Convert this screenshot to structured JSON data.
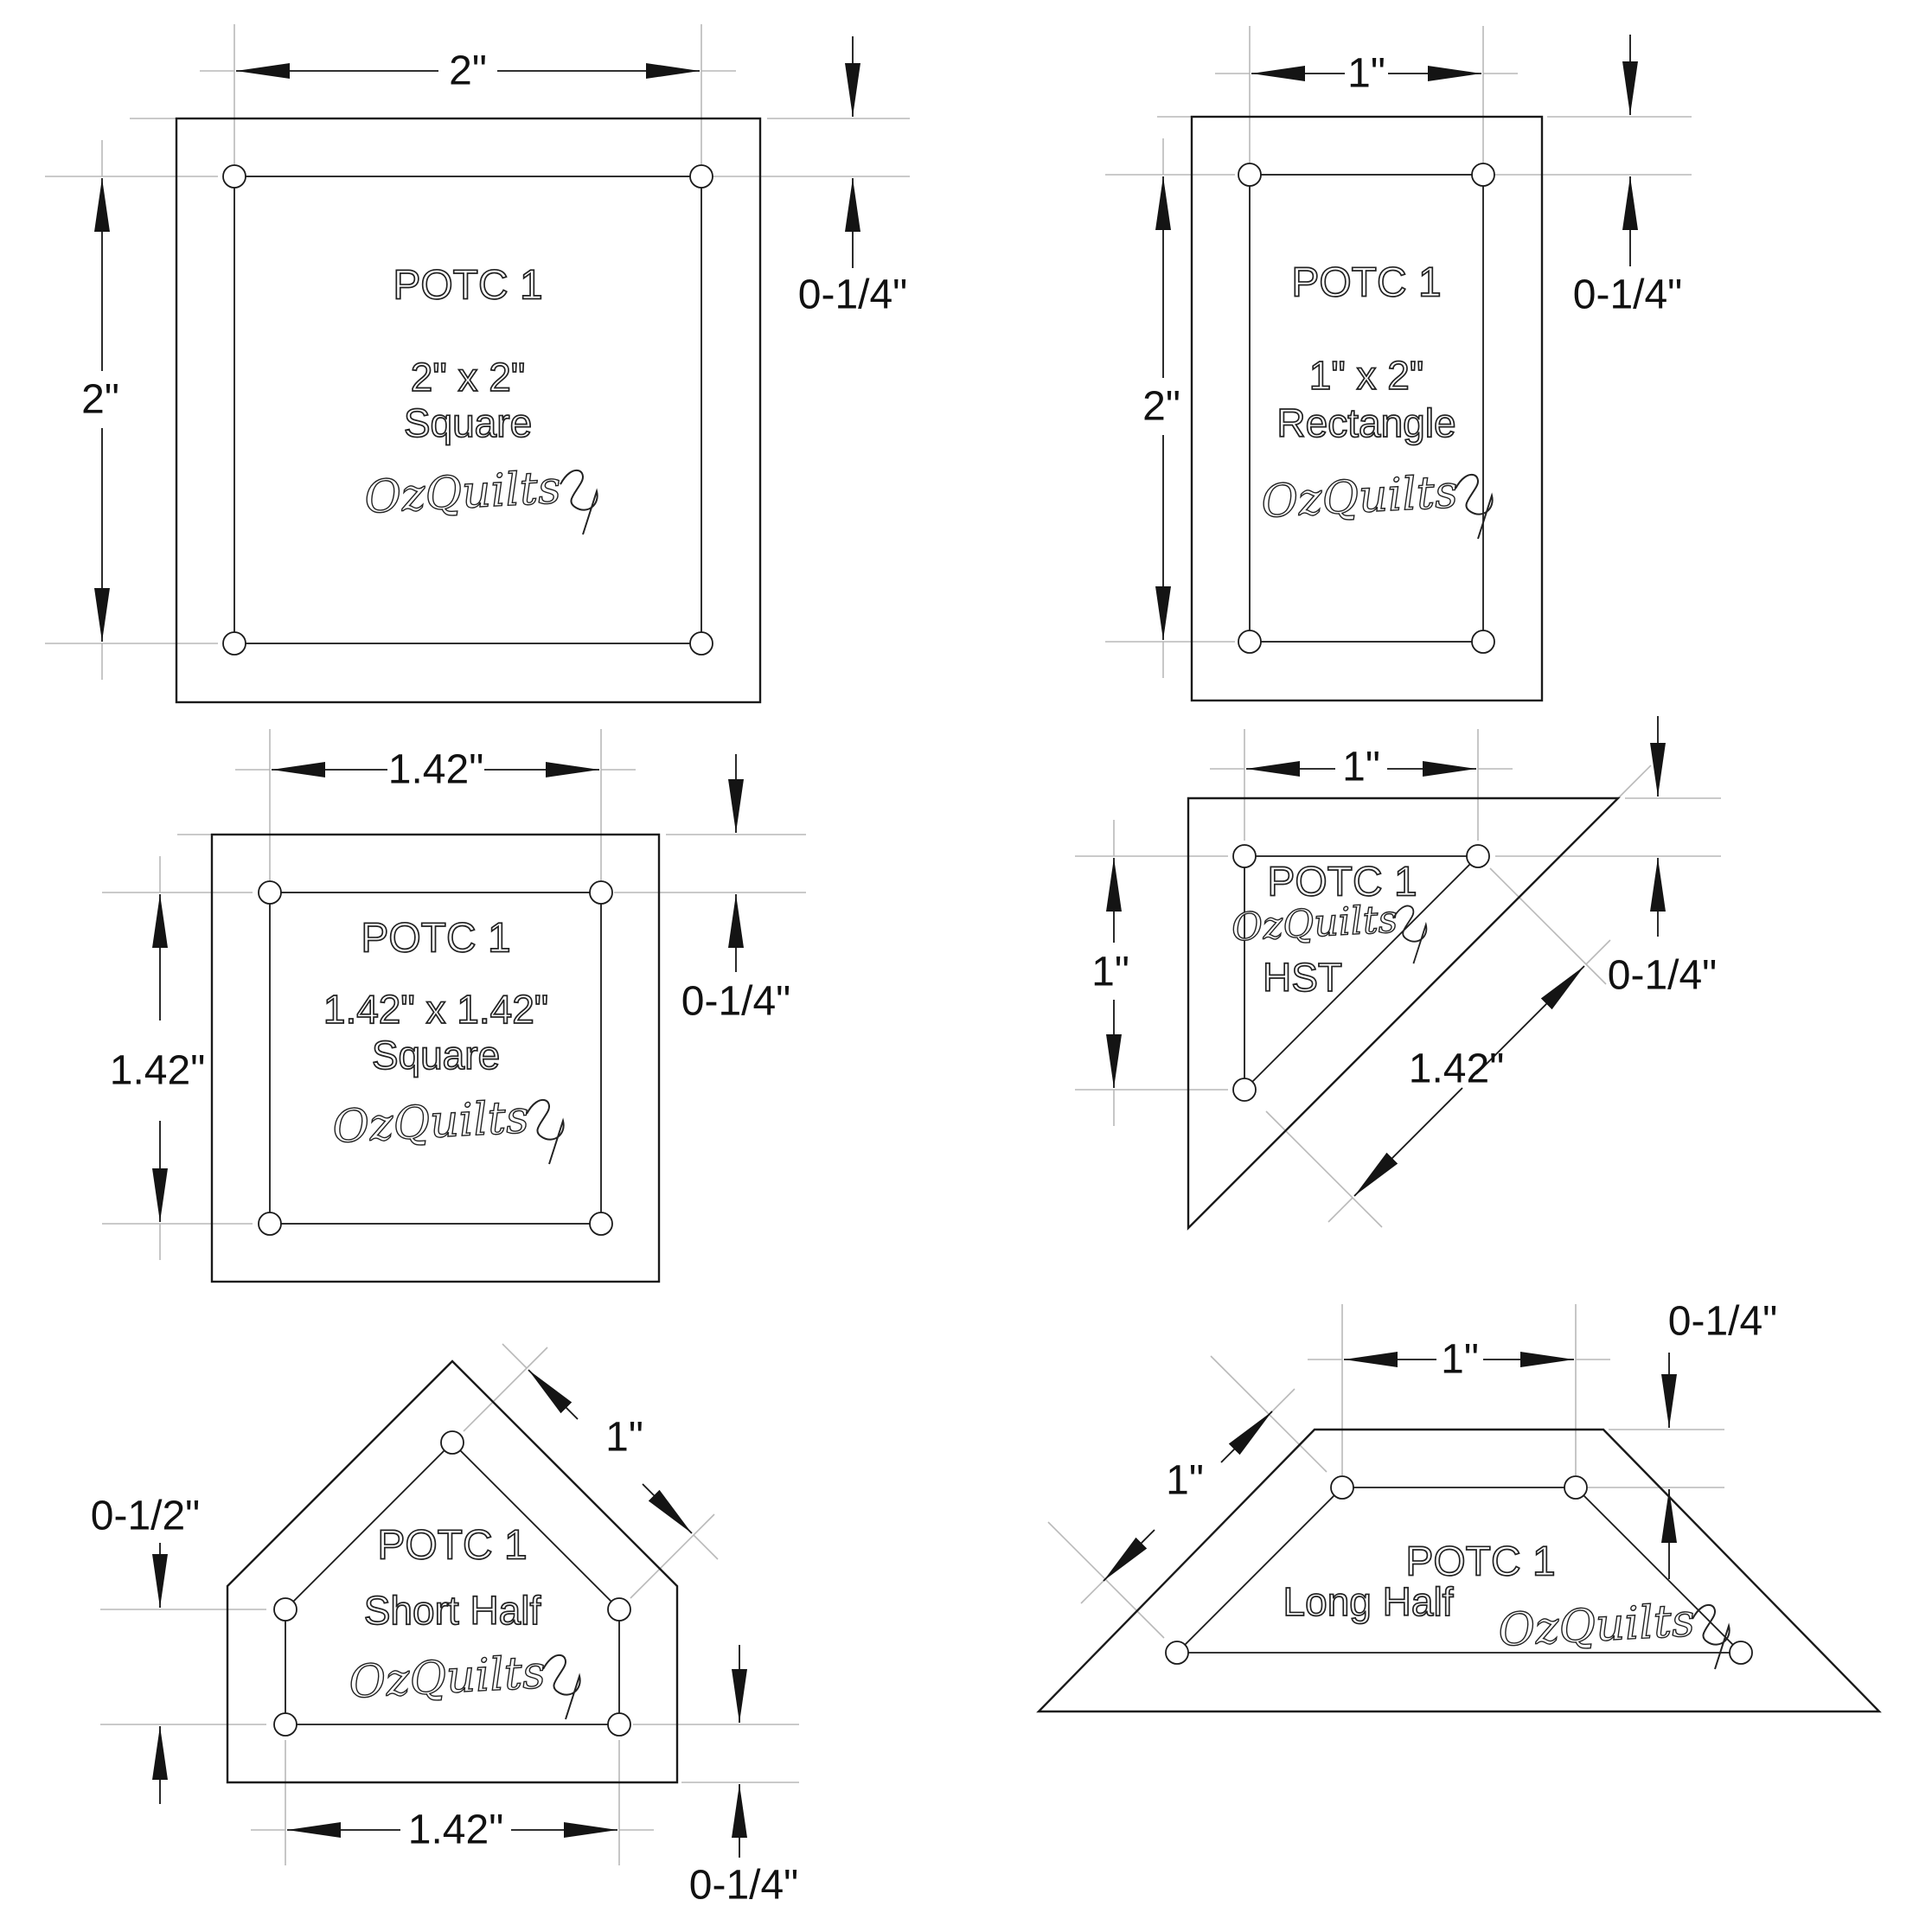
{
  "drawing": {
    "background": "#ffffff",
    "ink_color": "#1a1a1a",
    "construction_color": "#b9b9b9",
    "templates": [
      {
        "name": "square-2x2",
        "title": "POTC 1",
        "size_label": "2\" x 2\"",
        "shape_label": "Square",
        "brand": "OzQuilts",
        "dim_width": "2\"",
        "dim_height": "2\"",
        "dim_seam": "0-1/4\""
      },
      {
        "name": "rectangle-1x2",
        "title": "POTC 1",
        "size_label": "1\" x 2\"",
        "shape_label": "Rectangle",
        "brand": "OzQuilts",
        "dim_width": "1\"",
        "dim_height": "2\"",
        "dim_seam": "0-1/4\""
      },
      {
        "name": "square-1.42x1.42",
        "title": "POTC 1",
        "size_label": "1.42\" x 1.42\"",
        "shape_label": "Square",
        "brand": "OzQuilts",
        "dim_width": "1.42\"",
        "dim_height": "1.42\"",
        "dim_seam": "0-1/4\""
      },
      {
        "name": "half-square-triangle",
        "title": "POTC 1",
        "shape_label": "HST",
        "brand": "OzQuilts",
        "dim_width": "1\"",
        "dim_height": "1\"",
        "dim_hypotenuse": "1.42\"",
        "dim_seam": "0-1/4\""
      },
      {
        "name": "short-half",
        "title": "POTC 1",
        "shape_label": "Short Half",
        "brand": "OzQuilts",
        "dim_side": "0-1/2\"",
        "dim_slant": "1\"",
        "dim_bottom": "1.42\"",
        "dim_seam": "0-1/4\""
      },
      {
        "name": "long-half",
        "title": "POTC 1",
        "shape_label": "Long Half",
        "brand": "OzQuilts",
        "dim_top": "1\"",
        "dim_slant": "1\"",
        "dim_seam": "0-1/4\""
      }
    ]
  }
}
